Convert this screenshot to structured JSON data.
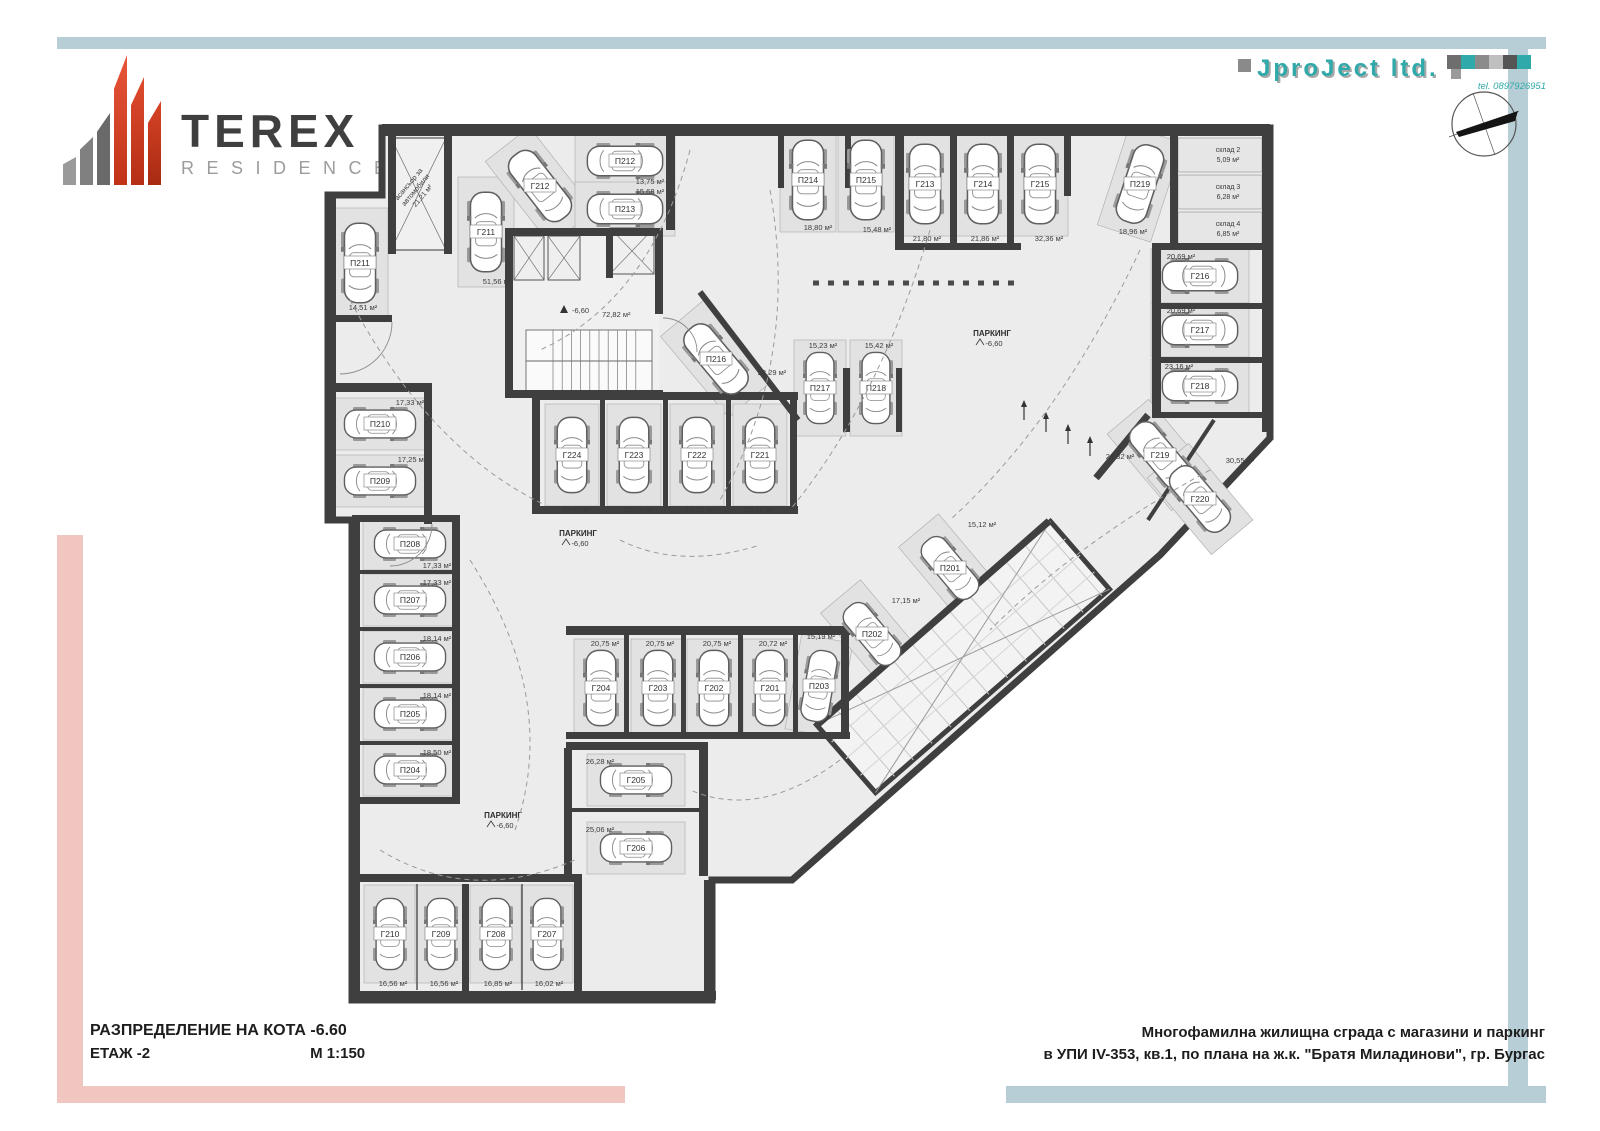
{
  "logo": {
    "title": "TEREX",
    "subtitle": "RESIDENCE"
  },
  "firm": {
    "name": "JproJect ltd.",
    "tel": "tel. 0897926951"
  },
  "title_block": {
    "line1": "РАЗПРЕДЕЛЕНИЕ НА КОТА -6.60",
    "line2": "ЕТАЖ -2",
    "scale": "М 1:150"
  },
  "project_block": {
    "line1": "Многофамилна жилищна сграда с магазини и паркинг",
    "line2": "в УПИ IV-353, кв.1, по плана на ж.к. \"Братя Миладинови\", гр. Бургас"
  },
  "colors": {
    "accent_teal": "#2fa9a9",
    "band_blue": "#b8ced6",
    "band_pink": "#f1c6c1",
    "logo_red": "#d84a2b",
    "wall": "#3f3f3f",
    "floor": "#ececec"
  },
  "plan": {
    "parking_label": "ПАРКИНГ",
    "level": "-6,60",
    "lobby": {
      "level": "-6,60",
      "area": "72,82 м²"
    },
    "lift": {
      "lines": [
        "асансьор за",
        "автомобили",
        "21,21 м²"
      ]
    },
    "marks": [
      {
        "x": 578,
        "y": 536
      },
      {
        "x": 503,
        "y": 818
      },
      {
        "x": 992,
        "y": 336
      }
    ],
    "storage_rooms": [
      {
        "label": "склад 2",
        "area": "5,09 м²",
        "x": 1178,
        "y": 138,
        "w": 84,
        "h": 34
      },
      {
        "label": "склад 3",
        "area": "6,28 м²",
        "x": 1178,
        "y": 175,
        "w": 84,
        "h": 34
      },
      {
        "label": "склад 4",
        "area": "6,85 м²",
        "x": 1178,
        "y": 212,
        "w": 84,
        "h": 34
      }
    ],
    "spots": [
      {
        "label": "П211",
        "area": "14,51 м²",
        "cx": 360,
        "cy": 263,
        "w": 38,
        "h": 96,
        "rot": 0,
        "ax": 363,
        "ay": 310
      },
      {
        "label": "Г211",
        "area": "51,56 м²",
        "cx": 486,
        "cy": 232,
        "w": 38,
        "h": 96,
        "rot": 0,
        "ax": 497,
        "ay": 284
      },
      {
        "label": "Г212",
        "area": "",
        "cx": 540,
        "cy": 186,
        "w": 38,
        "h": 92,
        "rot": -38,
        "ax": 0,
        "ay": 0
      },
      {
        "label": "П212",
        "area": "13,75 м²",
        "cx": 625,
        "cy": 161,
        "w": 36,
        "h": 86,
        "rot": 90,
        "ax": 650,
        "ay": 184
      },
      {
        "label": "П213",
        "area": "15,68 м²",
        "cx": 625,
        "cy": 209,
        "w": 36,
        "h": 86,
        "rot": 90,
        "ax": 650,
        "ay": 194
      },
      {
        "label": "П214",
        "area": "18,80 м²",
        "cx": 808,
        "cy": 180,
        "w": 38,
        "h": 90,
        "rot": 0,
        "ax": 818,
        "ay": 230
      },
      {
        "label": "П215",
        "area": "15,48 м²",
        "cx": 866,
        "cy": 180,
        "w": 38,
        "h": 90,
        "rot": 0,
        "ax": 877,
        "ay": 232
      },
      {
        "label": "Г213",
        "area": "21,80 м²",
        "cx": 925,
        "cy": 184,
        "w": 38,
        "h": 90,
        "rot": 0,
        "ax": 927,
        "ay": 241
      },
      {
        "label": "Г214",
        "area": "21,86 м²",
        "cx": 983,
        "cy": 184,
        "w": 38,
        "h": 90,
        "rot": 0,
        "ax": 985,
        "ay": 241
      },
      {
        "label": "Г215",
        "area": "32,36 м²",
        "cx": 1040,
        "cy": 184,
        "w": 38,
        "h": 90,
        "rot": 0,
        "ax": 1049,
        "ay": 241
      },
      {
        "label": "П219",
        "area": "18,96 м²",
        "cx": 1140,
        "cy": 184,
        "w": 38,
        "h": 90,
        "rot": 18,
        "ax": 1133,
        "ay": 234
      },
      {
        "label": "Г216",
        "area": "20,69 м²",
        "cx": 1200,
        "cy": 276,
        "w": 36,
        "h": 84,
        "rot": -90,
        "ax": 1181,
        "ay": 259
      },
      {
        "label": "Г217",
        "area": "20,69 м²",
        "cx": 1200,
        "cy": 330,
        "w": 36,
        "h": 84,
        "rot": -90,
        "ax": 1181,
        "ay": 313
      },
      {
        "label": "Г218",
        "area": "23,16 м²",
        "cx": 1200,
        "cy": 386,
        "w": 36,
        "h": 84,
        "rot": -90,
        "ax": 1179,
        "ay": 369
      },
      {
        "label": "Г219",
        "area": "21,32 м²",
        "cx": 1160,
        "cy": 455,
        "w": 36,
        "h": 86,
        "rot": -40,
        "ax": 1120,
        "ay": 459
      },
      {
        "label": "Г220",
        "area": "30,55 м²",
        "cx": 1200,
        "cy": 499,
        "w": 36,
        "h": 86,
        "rot": -40,
        "ax": 1240,
        "ay": 463
      },
      {
        "label": "П216",
        "area": "28,29 м²",
        "cx": 716,
        "cy": 359,
        "w": 38,
        "h": 92,
        "rot": -40,
        "ax": 772,
        "ay": 375
      },
      {
        "label": "П217",
        "area": "15,23 м²",
        "cx": 820,
        "cy": 388,
        "w": 34,
        "h": 82,
        "rot": 0,
        "ax": 823,
        "ay": 348
      },
      {
        "label": "П218",
        "area": "15,42 м²",
        "cx": 876,
        "cy": 388,
        "w": 34,
        "h": 82,
        "rot": 0,
        "ax": 879,
        "ay": 348
      },
      {
        "label": "Г224",
        "area": "24,47 м²",
        "cx": 572,
        "cy": 455,
        "w": 36,
        "h": 88,
        "rot": 0,
        "ax": 577,
        "ay": 512
      },
      {
        "label": "Г223",
        "area": "23,50 м²",
        "cx": 634,
        "cy": 455,
        "w": 36,
        "h": 88,
        "rot": 0,
        "ax": 639,
        "ay": 512
      },
      {
        "label": "Г222",
        "area": "23,31 м²",
        "cx": 697,
        "cy": 455,
        "w": 36,
        "h": 88,
        "rot": 0,
        "ax": 700,
        "ay": 512
      },
      {
        "label": "Г221",
        "area": "23,32 м²",
        "cx": 760,
        "cy": 455,
        "w": 36,
        "h": 88,
        "rot": 0,
        "ax": 759,
        "ay": 512
      },
      {
        "label": "П210",
        "area": "17,33 м²",
        "cx": 380,
        "cy": 424,
        "w": 34,
        "h": 82,
        "rot": 90,
        "ax": 410,
        "ay": 405
      },
      {
        "label": "П209",
        "area": "17,25 м²",
        "cx": 380,
        "cy": 481,
        "w": 34,
        "h": 82,
        "rot": 90,
        "ax": 412,
        "ay": 462
      },
      {
        "label": "П208",
        "area": "17,33 м²",
        "cx": 410,
        "cy": 544,
        "w": 34,
        "h": 80,
        "rot": 90,
        "ax": 437,
        "ay": 568
      },
      {
        "label": "П207",
        "area": "17,33 м²",
        "cx": 410,
        "cy": 600,
        "w": 34,
        "h": 80,
        "rot": 90,
        "ax": 437,
        "ay": 585
      },
      {
        "label": "П206",
        "area": "18,14 м²",
        "cx": 410,
        "cy": 657,
        "w": 34,
        "h": 80,
        "rot": 90,
        "ax": 437,
        "ay": 641
      },
      {
        "label": "П205",
        "area": "18,14 м²",
        "cx": 410,
        "cy": 714,
        "w": 34,
        "h": 80,
        "rot": 90,
        "ax": 437,
        "ay": 698
      },
      {
        "label": "П204",
        "area": "18,50 м²",
        "cx": 410,
        "cy": 770,
        "w": 34,
        "h": 80,
        "rot": 90,
        "ax": 437,
        "ay": 755
      },
      {
        "label": "Г210",
        "area": "16,56 м²",
        "cx": 390,
        "cy": 934,
        "w": 34,
        "h": 84,
        "rot": 0,
        "ax": 393,
        "ay": 986
      },
      {
        "label": "Г209",
        "area": "16,56 м²",
        "cx": 441,
        "cy": 934,
        "w": 34,
        "h": 84,
        "rot": 0,
        "ax": 444,
        "ay": 986
      },
      {
        "label": "Г208",
        "area": "16,85 м²",
        "cx": 496,
        "cy": 934,
        "w": 34,
        "h": 84,
        "rot": 0,
        "ax": 498,
        "ay": 986
      },
      {
        "label": "Г207",
        "area": "16,02 м²",
        "cx": 547,
        "cy": 934,
        "w": 34,
        "h": 84,
        "rot": 0,
        "ax": 549,
        "ay": 986
      },
      {
        "label": "Г205",
        "area": "26,28 м²",
        "cx": 636,
        "cy": 780,
        "w": 34,
        "h": 84,
        "rot": 90,
        "ax": 600,
        "ay": 764
      },
      {
        "label": "Г206",
        "area": "25,06 м²",
        "cx": 636,
        "cy": 848,
        "w": 34,
        "h": 84,
        "rot": 90,
        "ax": 600,
        "ay": 832
      },
      {
        "label": "Г204",
        "area": "20,75 м²",
        "cx": 601,
        "cy": 688,
        "w": 36,
        "h": 84,
        "rot": 0,
        "ax": 605,
        "ay": 646
      },
      {
        "label": "Г203",
        "area": "20,75 м²",
        "cx": 658,
        "cy": 688,
        "w": 36,
        "h": 84,
        "rot": 0,
        "ax": 660,
        "ay": 646
      },
      {
        "label": "Г202",
        "area": "20,75 м²",
        "cx": 714,
        "cy": 688,
        "w": 36,
        "h": 84,
        "rot": 0,
        "ax": 717,
        "ay": 646
      },
      {
        "label": "Г201",
        "area": "20,72 м²",
        "cx": 770,
        "cy": 688,
        "w": 36,
        "h": 84,
        "rot": 0,
        "ax": 773,
        "ay": 646
      },
      {
        "label": "П203",
        "area": "15,19 м²",
        "cx": 819,
        "cy": 686,
        "w": 34,
        "h": 82,
        "rot": 10,
        "ax": 821,
        "ay": 639
      },
      {
        "label": "П202",
        "area": "17,15 м²",
        "cx": 872,
        "cy": 634,
        "w": 34,
        "h": 84,
        "rot": -40,
        "ax": 906,
        "ay": 603
      },
      {
        "label": "П201",
        "area": "15,12 м²",
        "cx": 950,
        "cy": 568,
        "w": 34,
        "h": 84,
        "rot": -40,
        "ax": 982,
        "ay": 527
      }
    ]
  }
}
